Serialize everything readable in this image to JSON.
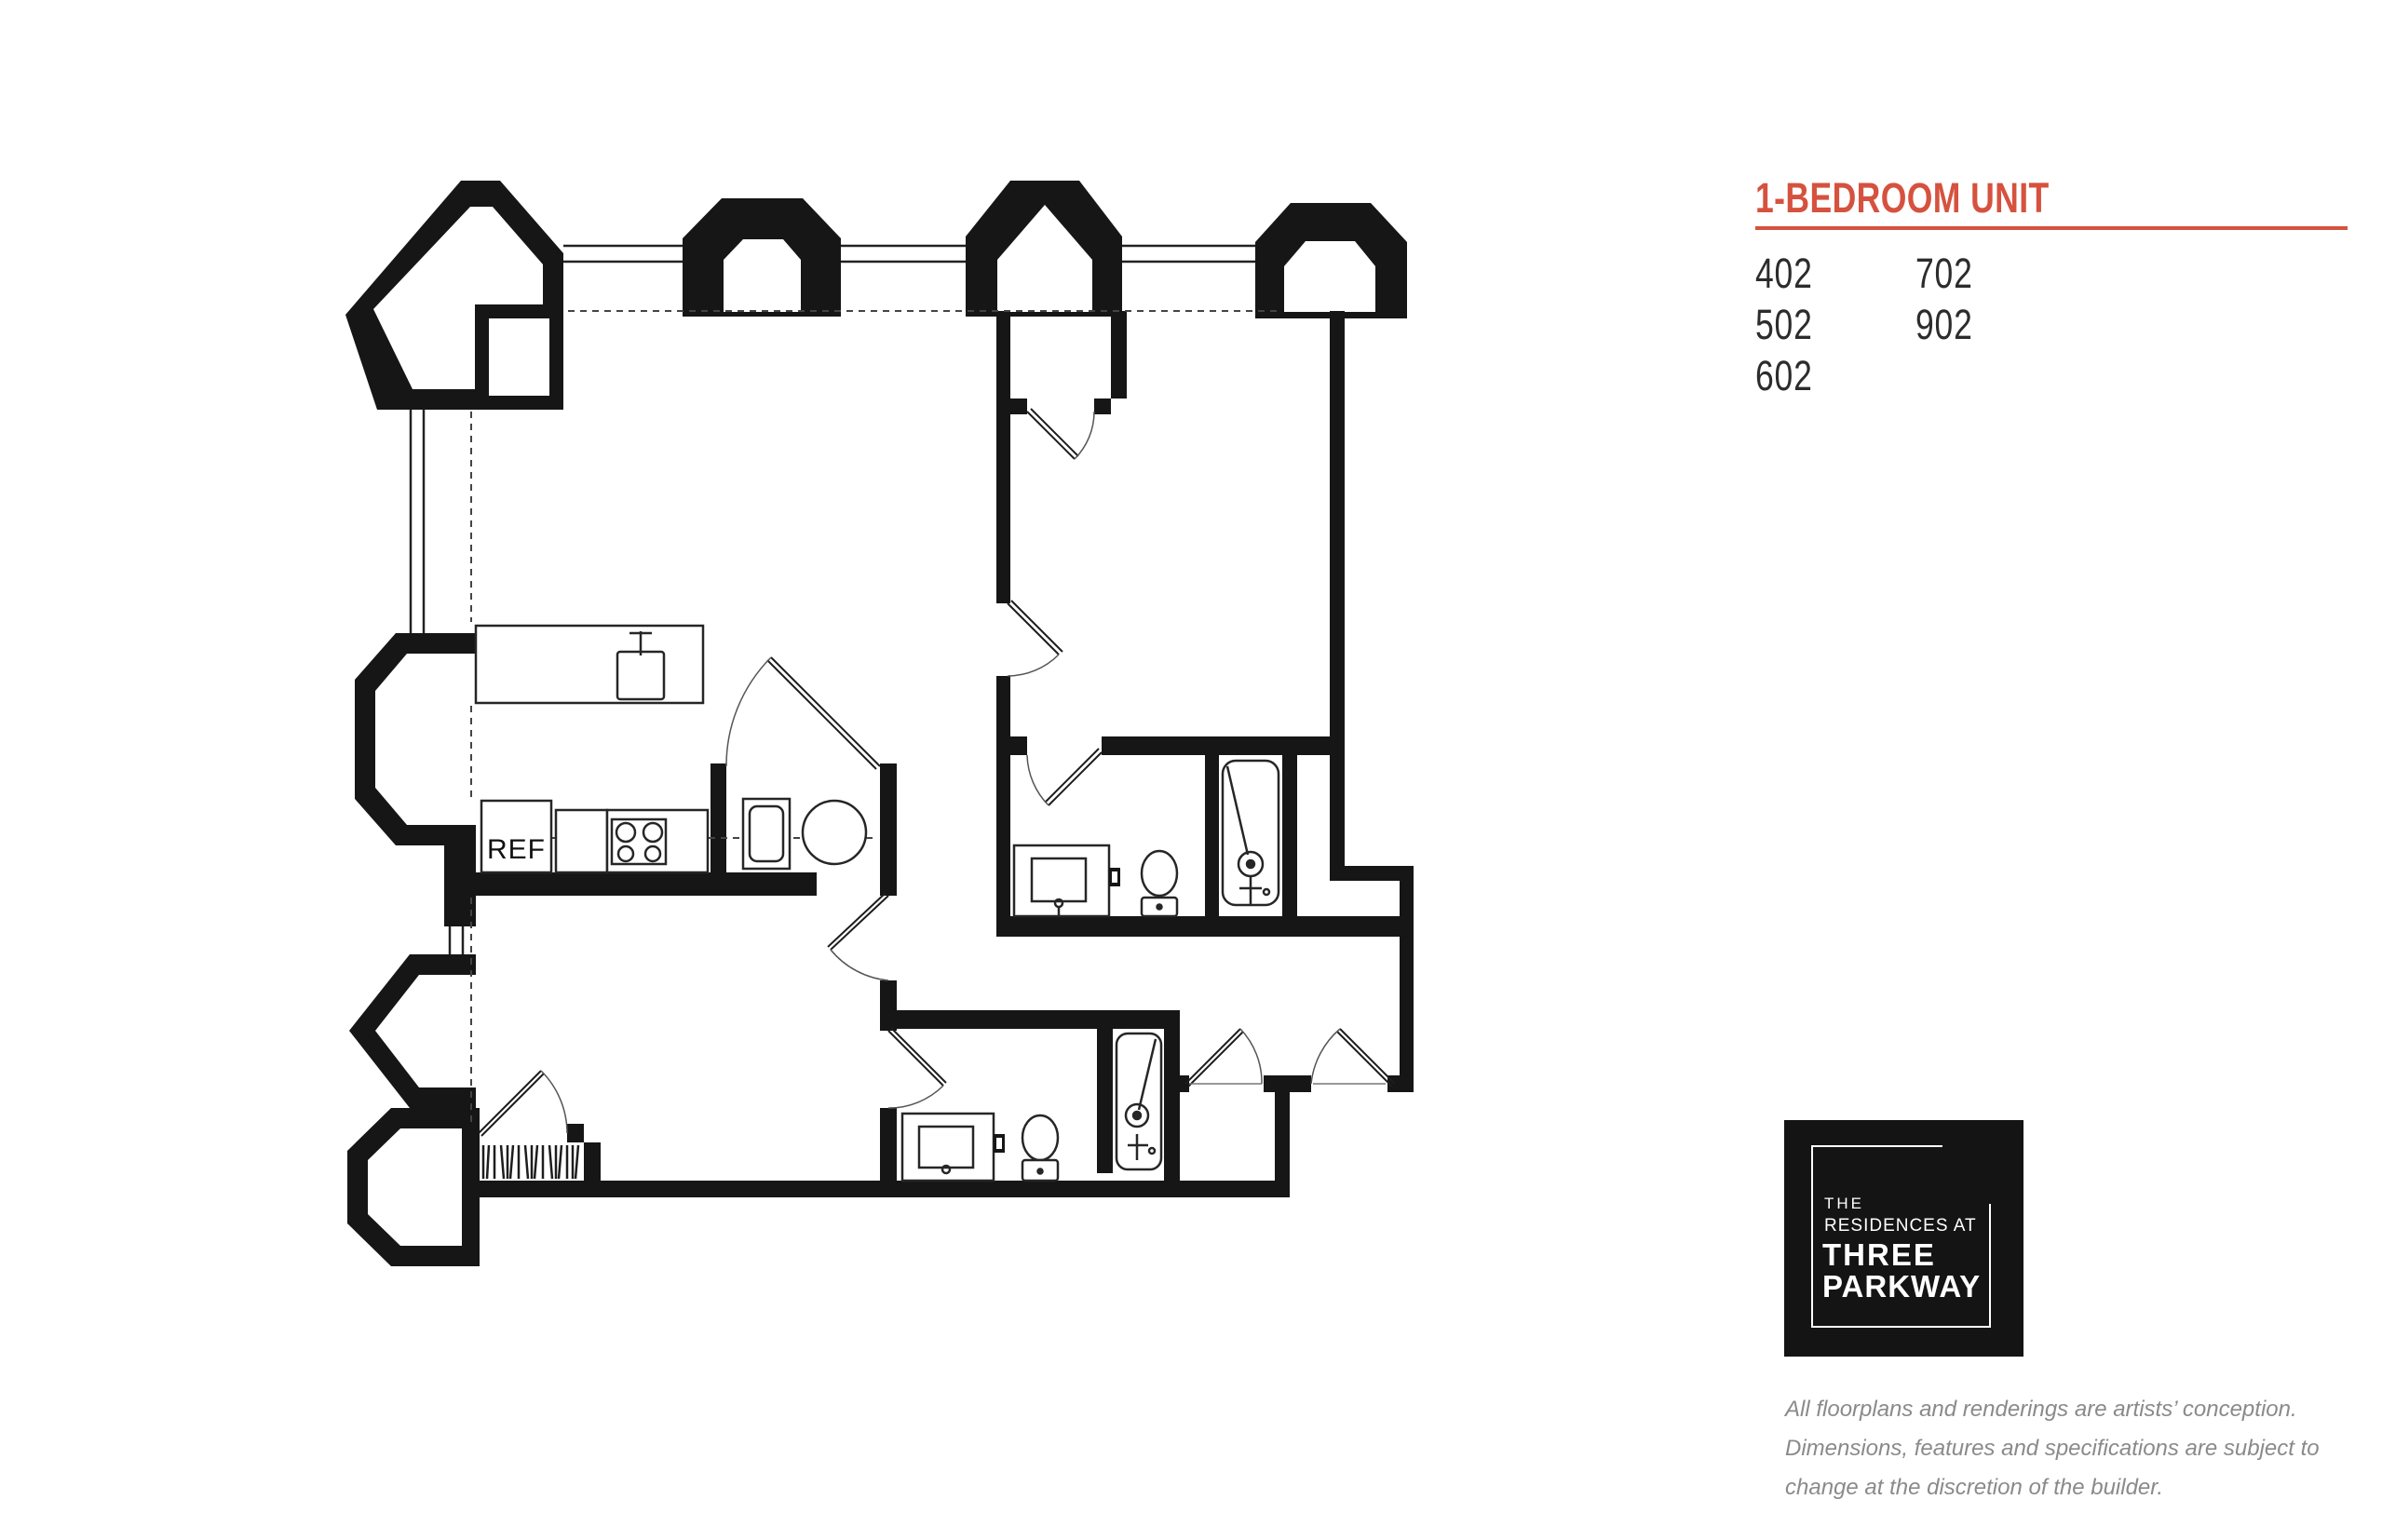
{
  "header": {
    "title": "1-BEDROOM UNIT",
    "accent_color": "#d5523f"
  },
  "units": {
    "col1": [
      "402",
      "502",
      "602"
    ],
    "col2": [
      "702",
      "902"
    ]
  },
  "floorplan": {
    "ref_label": "REF",
    "ink_color": "#161616"
  },
  "logo": {
    "line1": "THE",
    "line2": "RESIDENCES AT",
    "line3": "THREE",
    "line4": "PARKWAY",
    "background": "#141414"
  },
  "disclaimer": {
    "line1": "All floorplans and renderings are artists’ conception.",
    "line2": "Dimensions, features and specifications are subject to",
    "line3": "change at the discretion of the builder."
  }
}
